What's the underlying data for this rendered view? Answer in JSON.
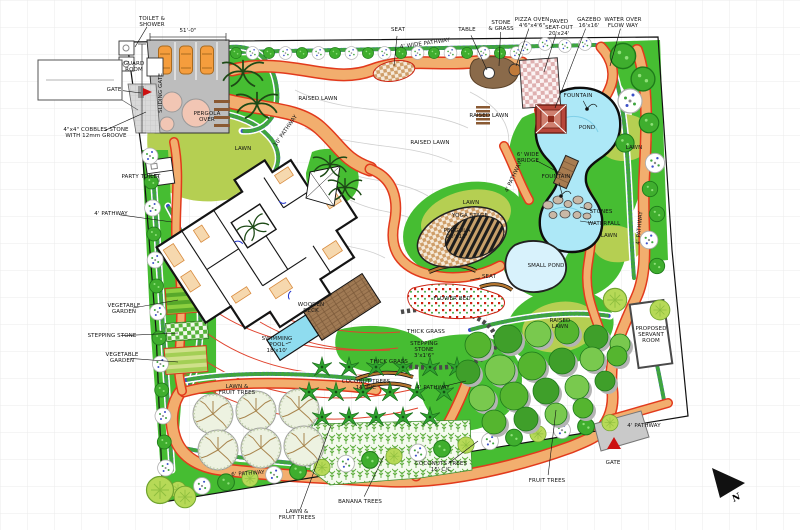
{
  "colors": {
    "path_fill": "#f2ae6e",
    "path_edge": "#e23a1c",
    "lawn_bright": "#46bd32",
    "lawn_olive": "#b5cf52",
    "water": "#ade8f7",
    "water_light": "#d8f2fc",
    "structure_gray": "#bdbdbd",
    "roof_red": "#b8473a",
    "deck_brown": "#a07a54",
    "car_orange": "#f59d3d",
    "flower_blue": "#3c50c8",
    "flower_green": "#3fa53f"
  },
  "north": {
    "label": "N"
  },
  "labels": [
    {
      "id": "toilet-shower",
      "text": "TOILET &\nSHOWER",
      "x": 152,
      "y": 22,
      "leader": [
        135,
        47
      ]
    },
    {
      "id": "dim-51",
      "text": "51'-0\"",
      "x": 188,
      "y": 31
    },
    {
      "id": "guard-room",
      "text": "GUARD\nROOM",
      "x": 134,
      "y": 67
    },
    {
      "id": "gate-left",
      "text": "GATE",
      "x": 114,
      "y": 90,
      "leader": [
        141,
        93
      ]
    },
    {
      "id": "sliding-gate",
      "text": "SLIDING GATE",
      "x": 161,
      "y": 93,
      "rot": -90
    },
    {
      "id": "pergola-over",
      "text": "PERGOLA\nOVER",
      "x": 207,
      "y": 117
    },
    {
      "id": "cobbles-note",
      "text": "4\"x4\" COBBLES STONE\nWITH 12mm GROOVE",
      "x": 96,
      "y": 133,
      "leader": [
        146,
        112
      ]
    },
    {
      "id": "party-toilet",
      "text": "PARTY TOILET",
      "x": 141,
      "y": 177,
      "leader": [
        160,
        174
      ]
    },
    {
      "id": "pathway-left",
      "text": "4' PATHWAY",
      "x": 111,
      "y": 214,
      "leader": [
        172,
        222
      ]
    },
    {
      "id": "veg-garden-1",
      "text": "VEGETABLE\nGARDEN",
      "x": 124,
      "y": 309,
      "leader": [
        178,
        300
      ]
    },
    {
      "id": "stepping-stone-left",
      "text": "STEPPING STONE",
      "x": 112,
      "y": 336,
      "leader": [
        178,
        333
      ]
    },
    {
      "id": "veg-garden-2",
      "text": "VEGETABLE\nGARDEN",
      "x": 122,
      "y": 358,
      "leader": [
        178,
        362
      ]
    },
    {
      "id": "seat-top",
      "text": "SEAT",
      "x": 398,
      "y": 30,
      "leader": [
        394,
        66
      ]
    },
    {
      "id": "table",
      "text": "TABLE",
      "x": 467,
      "y": 30,
      "leader": [
        487,
        70
      ]
    },
    {
      "id": "stone-grass",
      "text": "STONE\n& GRASS",
      "x": 501,
      "y": 26,
      "leader": [
        499,
        66
      ]
    },
    {
      "id": "pizza-oven",
      "text": "PIZZA OVEN\n4'6\"x4'6\"",
      "x": 532,
      "y": 23,
      "leader": [
        516,
        66
      ]
    },
    {
      "id": "paved-seat-out",
      "text": "PAVED\nSEAT-OUT\n20'x24'",
      "x": 559,
      "y": 28,
      "leader": [
        544,
        72
      ]
    },
    {
      "id": "gazebo",
      "text": "GAZEBO\n16'x16'",
      "x": 589,
      "y": 23,
      "leader": [
        555,
        108
      ]
    },
    {
      "id": "water-overflow",
      "text": "WATER OVER\nFLOW WAY",
      "x": 623,
      "y": 23,
      "leader": [
        610,
        66
      ]
    },
    {
      "id": "pathway-top",
      "text": "4' WIDE PATHWAY",
      "x": 425,
      "y": 44,
      "rot": -8
    },
    {
      "id": "raised-lawn-1",
      "text": "RAISED LAWN",
      "x": 318,
      "y": 99
    },
    {
      "id": "raised-lawn-2",
      "text": "RAISED LAWN",
      "x": 489,
      "y": 116
    },
    {
      "id": "raised-lawn-3",
      "text": "RAISED LAWN",
      "x": 430,
      "y": 143
    },
    {
      "id": "pathway-10",
      "text": "10' PATHWAY",
      "x": 286,
      "y": 131,
      "rot": -55
    },
    {
      "id": "lawn-1",
      "text": "LAWN",
      "x": 243,
      "y": 149
    },
    {
      "id": "fountain-1",
      "text": "FOUNTAIN",
      "x": 578,
      "y": 96,
      "leader": [
        588,
        110
      ]
    },
    {
      "id": "pond",
      "text": "POND",
      "x": 587,
      "y": 128
    },
    {
      "id": "bridge",
      "text": "6' WIDE\nBRIDGE",
      "x": 528,
      "y": 158,
      "leader": [
        558,
        172
      ]
    },
    {
      "id": "fountain-2",
      "text": "FOUNTAIN",
      "x": 556,
      "y": 177,
      "leader": [
        562,
        194
      ]
    },
    {
      "id": "lawn-2",
      "text": "LAWN",
      "x": 634,
      "y": 148
    },
    {
      "id": "pathway-4a",
      "text": "4' PATHWAY",
      "x": 514,
      "y": 177,
      "rot": -65
    },
    {
      "id": "lawn-3",
      "text": "LAWN",
      "x": 471,
      "y": 203
    },
    {
      "id": "yoga-stage",
      "text": "YOGA STAGE",
      "x": 470,
      "y": 216,
      "leader": [
        452,
        231
      ]
    },
    {
      "id": "pergola-20",
      "text": "PERGOLA\n20'x12'",
      "x": 457,
      "y": 234,
      "leader": [
        444,
        247
      ]
    },
    {
      "id": "stones",
      "text": "STONES",
      "x": 601,
      "y": 212,
      "leader": [
        580,
        207
      ]
    },
    {
      "id": "waterfall",
      "text": "WATERFALL",
      "x": 604,
      "y": 224,
      "leader": [
        580,
        221
      ]
    },
    {
      "id": "lawn-4",
      "text": "LAWN",
      "x": 609,
      "y": 236
    },
    {
      "id": "small-pond",
      "text": "SMALL POND",
      "x": 546,
      "y": 266
    },
    {
      "id": "seat-2",
      "text": "SEAT",
      "x": 489,
      "y": 277,
      "leader": [
        470,
        280
      ]
    },
    {
      "id": "flower-bed",
      "text": "FLOWER BED",
      "x": 452,
      "y": 299
    },
    {
      "id": "pathway-right",
      "text": "4' PATHWAY",
      "x": 640,
      "y": 228,
      "rot": -85
    },
    {
      "id": "wooden-deck",
      "text": "WOODEN\nDECK",
      "x": 311,
      "y": 308
    },
    {
      "id": "swimming-pool",
      "text": "SWIMMING\nPOOL\n18'x10'",
      "x": 277,
      "y": 345,
      "leader": [
        291,
        342
      ]
    },
    {
      "id": "thick-grass-1",
      "text": "THICK GRASS",
      "x": 426,
      "y": 332
    },
    {
      "id": "stepping-stone-2",
      "text": "STEPPING\nSTONE\n3'x1'6\"",
      "x": 424,
      "y": 350
    },
    {
      "id": "thick-grass-2",
      "text": "THICK GRASS",
      "x": 389,
      "y": 362
    },
    {
      "id": "lawn-fruit-1",
      "text": "LAWN &\nFRUIT TREES",
      "x": 237,
      "y": 390
    },
    {
      "id": "coconut-1",
      "text": "COCONUT TREES\n15' C/C",
      "x": 366,
      "y": 385
    },
    {
      "id": "pathway-4b",
      "text": "4' PATHWAY",
      "x": 433,
      "y": 388,
      "leader": [
        466,
        381
      ]
    },
    {
      "id": "raised-lawn-4",
      "text": "RAISED\nLAWN",
      "x": 560,
      "y": 324
    },
    {
      "id": "servant-room",
      "text": "PROPOSED\nSERVANT\nROOM",
      "x": 651,
      "y": 335
    },
    {
      "id": "pathway-4c",
      "text": "4' PATHWAY",
      "x": 644,
      "y": 426
    },
    {
      "id": "gate-right",
      "text": "GATE",
      "x": 613,
      "y": 463
    },
    {
      "id": "fruit-trees",
      "text": "FRUIT TREES",
      "x": 547,
      "y": 481,
      "leader": [
        556,
        410
      ]
    },
    {
      "id": "pathway-6",
      "text": "6' PATHWAY",
      "x": 248,
      "y": 474,
      "rot": -4
    },
    {
      "id": "banana-trees",
      "text": "BANANA TREES",
      "x": 360,
      "y": 502,
      "leader": [
        384,
        456
      ]
    },
    {
      "id": "lawn-fruit-2",
      "text": "LAWN &\nFRUIT TREES",
      "x": 297,
      "y": 515,
      "leader": [
        331,
        425
      ]
    },
    {
      "id": "coconuts-2",
      "text": "COCONUTS TREES\n15' C/C",
      "x": 441,
      "y": 467,
      "leader": [
        478,
        441
      ]
    }
  ]
}
